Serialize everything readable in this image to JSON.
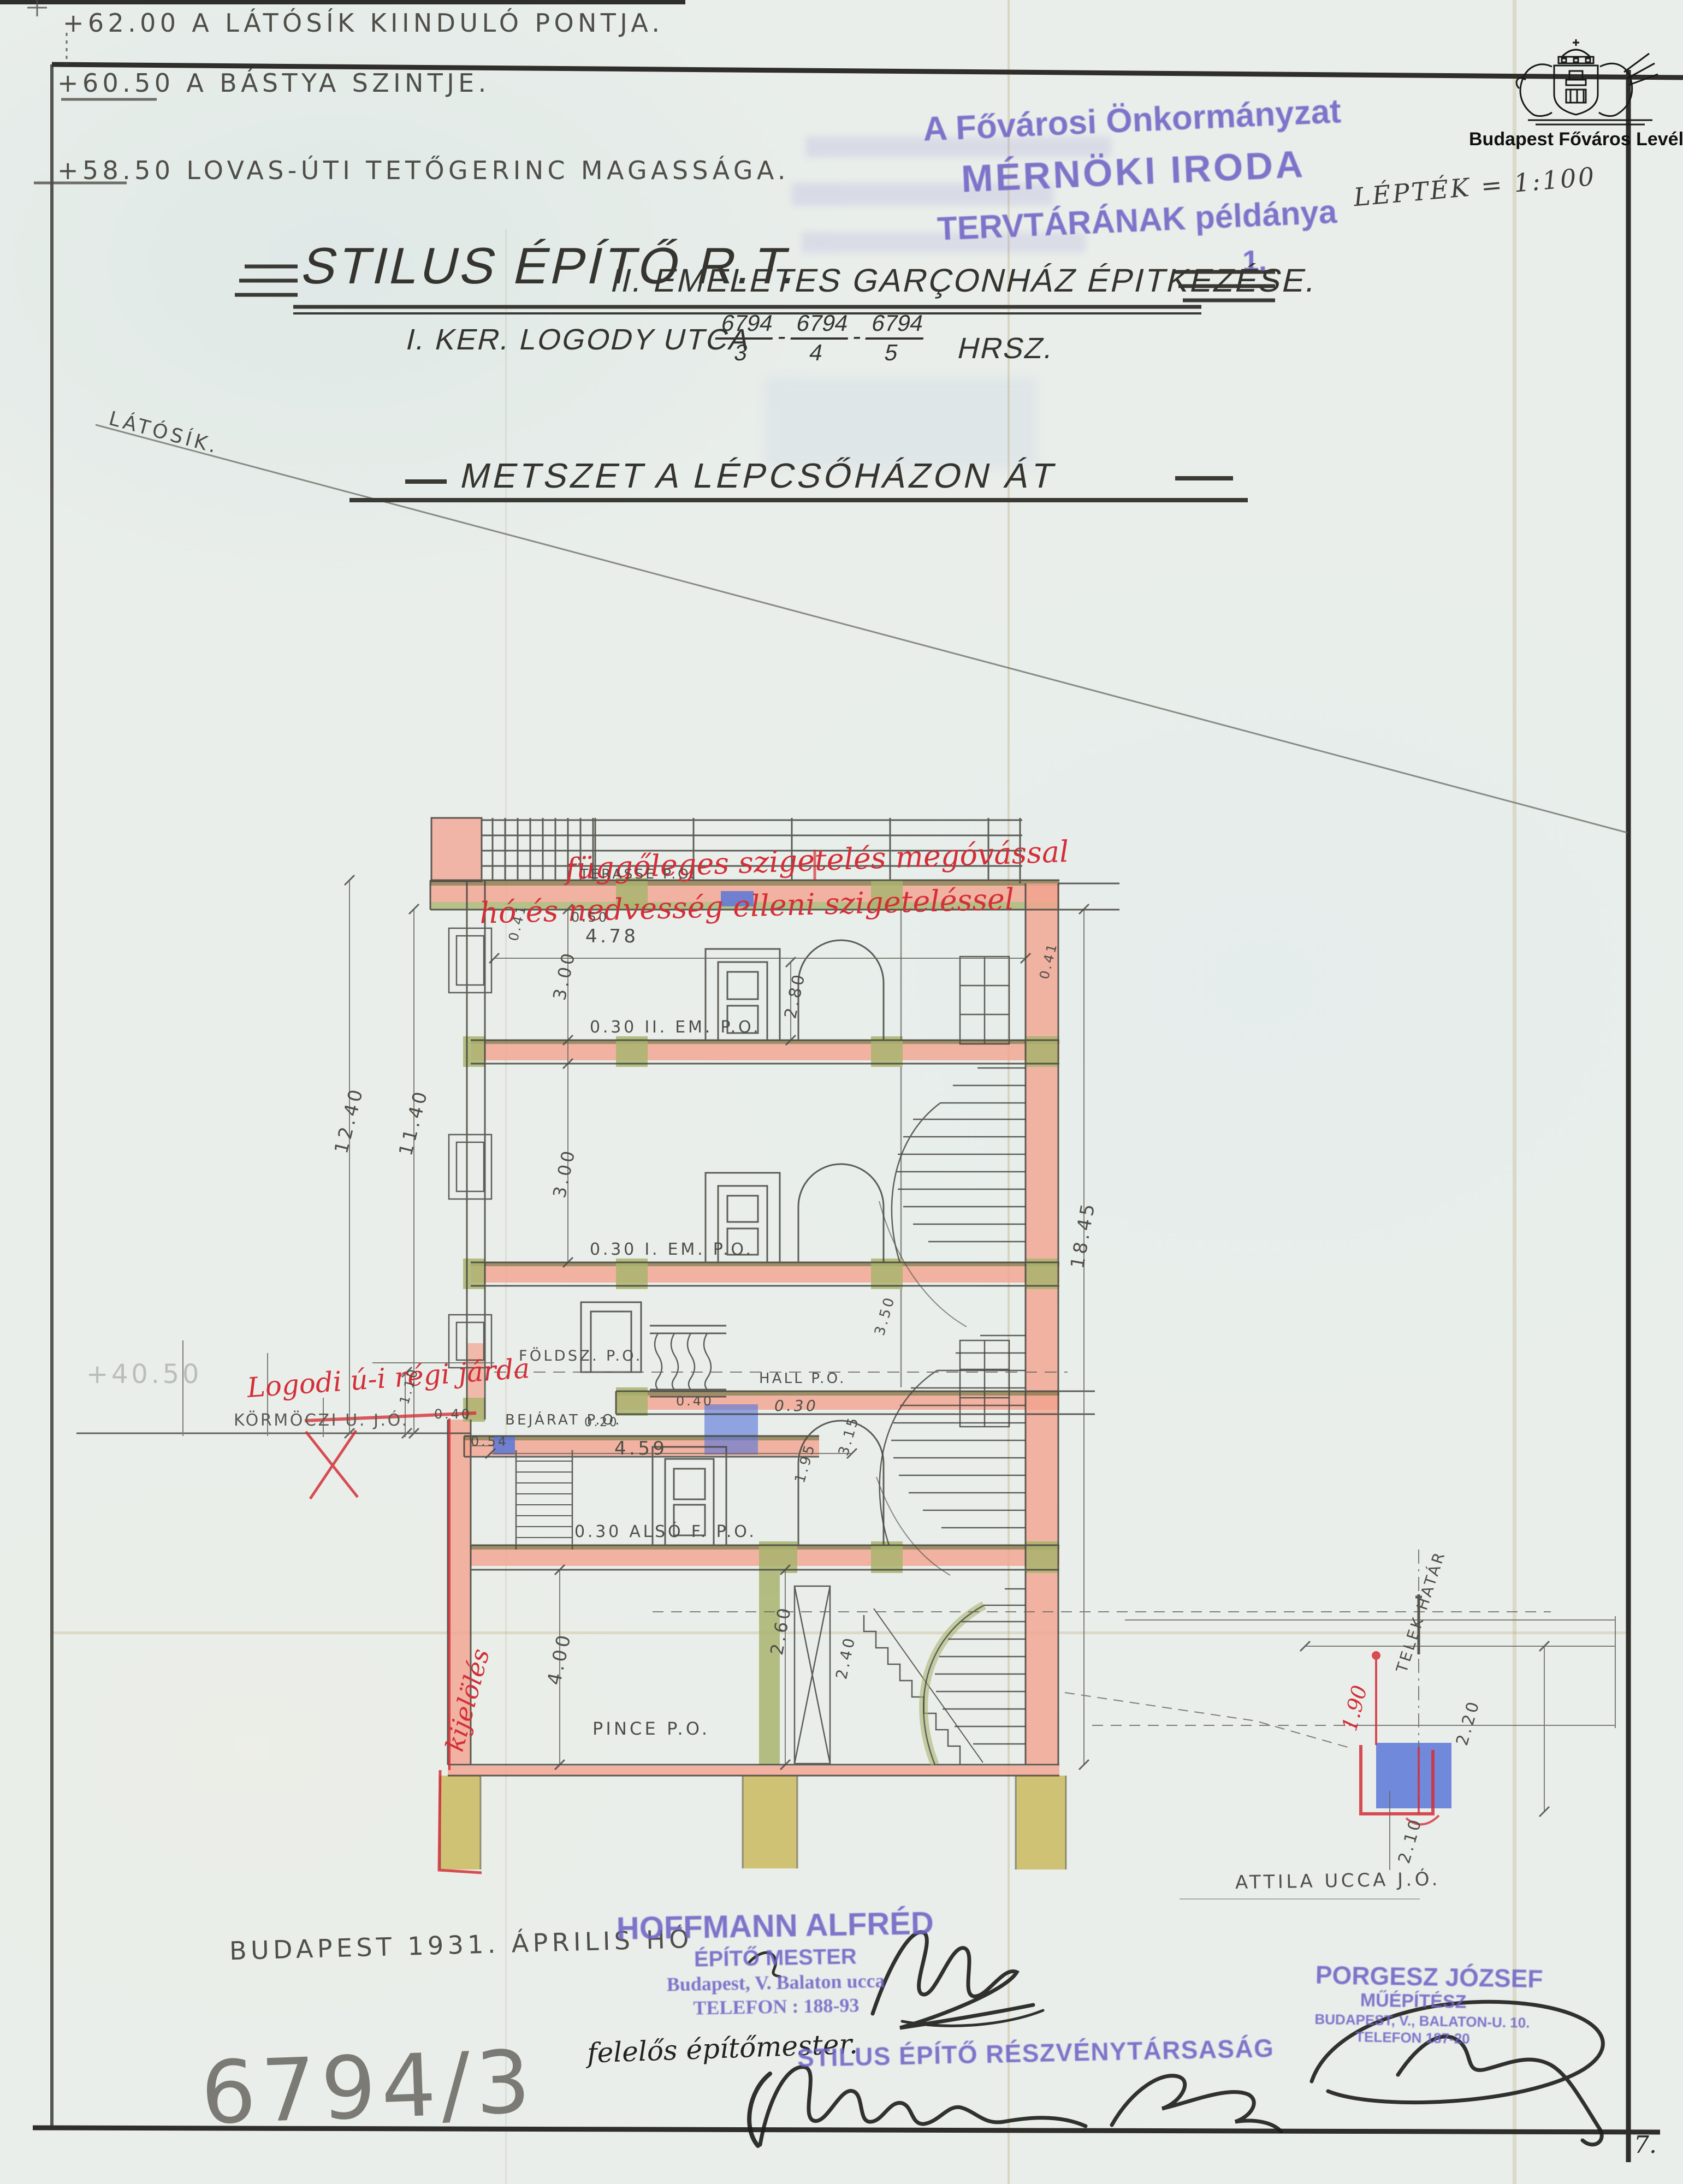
{
  "colors": {
    "paper": "#e9eeea",
    "pencil": "#4f4e48",
    "ink": "#2b2a26",
    "stamp_purple": "#6f64c6",
    "annotation_red": "#d42f38",
    "wall_pink": "#f2a28f",
    "timber_green": "#a9b46f",
    "foundation_ochre": "#c9b757",
    "detail_blue": "#5a77d8",
    "slab_brown": "#8f7d50"
  },
  "header": {
    "elevations": [
      {
        "value_label": "+62.00 A LÁTÓSÍK KIINDULÓ PONTJA."
      },
      {
        "value_label": "+60.50 A BÁSTYA SZINTJE."
      },
      {
        "value_label": "+58.50 LOVAS-ÚTI TETŐGERINC MAGASSÁGA."
      }
    ],
    "latosik_label": "LÁTÓSÍK.",
    "scale_label": "LÉPTÉK = 1:100"
  },
  "archive_stamp": {
    "line1": "A Fővárosi Önkormányzat",
    "line2": "MÉRNÖKI IRODA",
    "line3": "TERVTÁRÁNAK példánya",
    "copy_number": "1."
  },
  "logo": {
    "caption": "Budapest Főváros Levéltára"
  },
  "title": {
    "company": "STILUS ÉPÍTŐ R.T.",
    "project": "II. EMELETES GARÇONHÁZ ÉPITKEZÉSE.",
    "address_prefix": "I. KER. LOGODY UTCA",
    "lots": [
      {
        "num": "6794",
        "den": "3"
      },
      {
        "num": "6794",
        "den": "4"
      },
      {
        "num": "6794",
        "den": "5"
      }
    ],
    "lot_separator": "-",
    "address_suffix": "HRSZ.",
    "subtitle": "METSZET A LÉPCSŐHÁZON ÁT"
  },
  "drawing": {
    "floor_labels": {
      "terasse": "TERASSE P.O.",
      "em2": "0.30 II. EM. P.O.",
      "em1": "0.30 I. EM. P.O.",
      "foldsz": "FÖLDSZ. P.O.",
      "hall": "HALL P.O.",
      "bejarat": "BEJÁRAT P.O.",
      "alsof": "0.30 ALSÓ F. P.O.",
      "pince": "PINCE P.O."
    },
    "dims": {
      "d478": "4.78",
      "d041": "0.41",
      "d300": "3.00",
      "d280": "2.80",
      "d050": "0.50",
      "d1240": "12.40",
      "d1140": "11.40",
      "d1845": "18.45",
      "d110": "1.10",
      "d040": "0.40",
      "d020": "0.20",
      "d030": "0.30",
      "d054": "0.54",
      "d459": "4.59",
      "d195": "1.95",
      "d315": "3.15",
      "d350": "3.50",
      "d400": "4.00",
      "d260": "2.60",
      "d240": "2.40",
      "d190": "1.90",
      "d220": "2.20",
      "d210": "2.10"
    },
    "red_notes": {
      "top1": "függőleges szigetelés megóvással",
      "top2": "hó és nedvesség elleni szigeteléssel",
      "sidewalk": "Logodi ú-i régi járda",
      "vertical": "kijelölés"
    },
    "pencil_notes": {
      "street": "KÖRMÖCZI U. J.Ó.",
      "level_4050": "+40.50",
      "telek_hatar": "TELEK HATÁR",
      "attila": "ATTILA UCCA J.Ó."
    }
  },
  "footer": {
    "date": "BUDAPEST 1931. ÁPRILIS HÓ",
    "hoffmann_stamp": {
      "l1": "HOFFMANN ALFRÉD",
      "l2": "ÉPÍTŐ MESTER",
      "l3": "Budapest, V. Balaton ucca",
      "l4": "TELEFON : 188-93"
    },
    "felelos": "felelős építőmester.",
    "stilus_stamp": "STILUS ÉPÍTŐ RÉSZVÉNYTÁRSASÁG",
    "porgesz_stamp": {
      "l1": "PORGESZ JÓZSEF",
      "l2": "MŰÉPÍTÉSZ",
      "l3": "BUDAPEST, V., BALATON-U. 10.",
      "l4": "TELEFON 187-20"
    },
    "lot_big": "6794/3",
    "page": "7."
  }
}
